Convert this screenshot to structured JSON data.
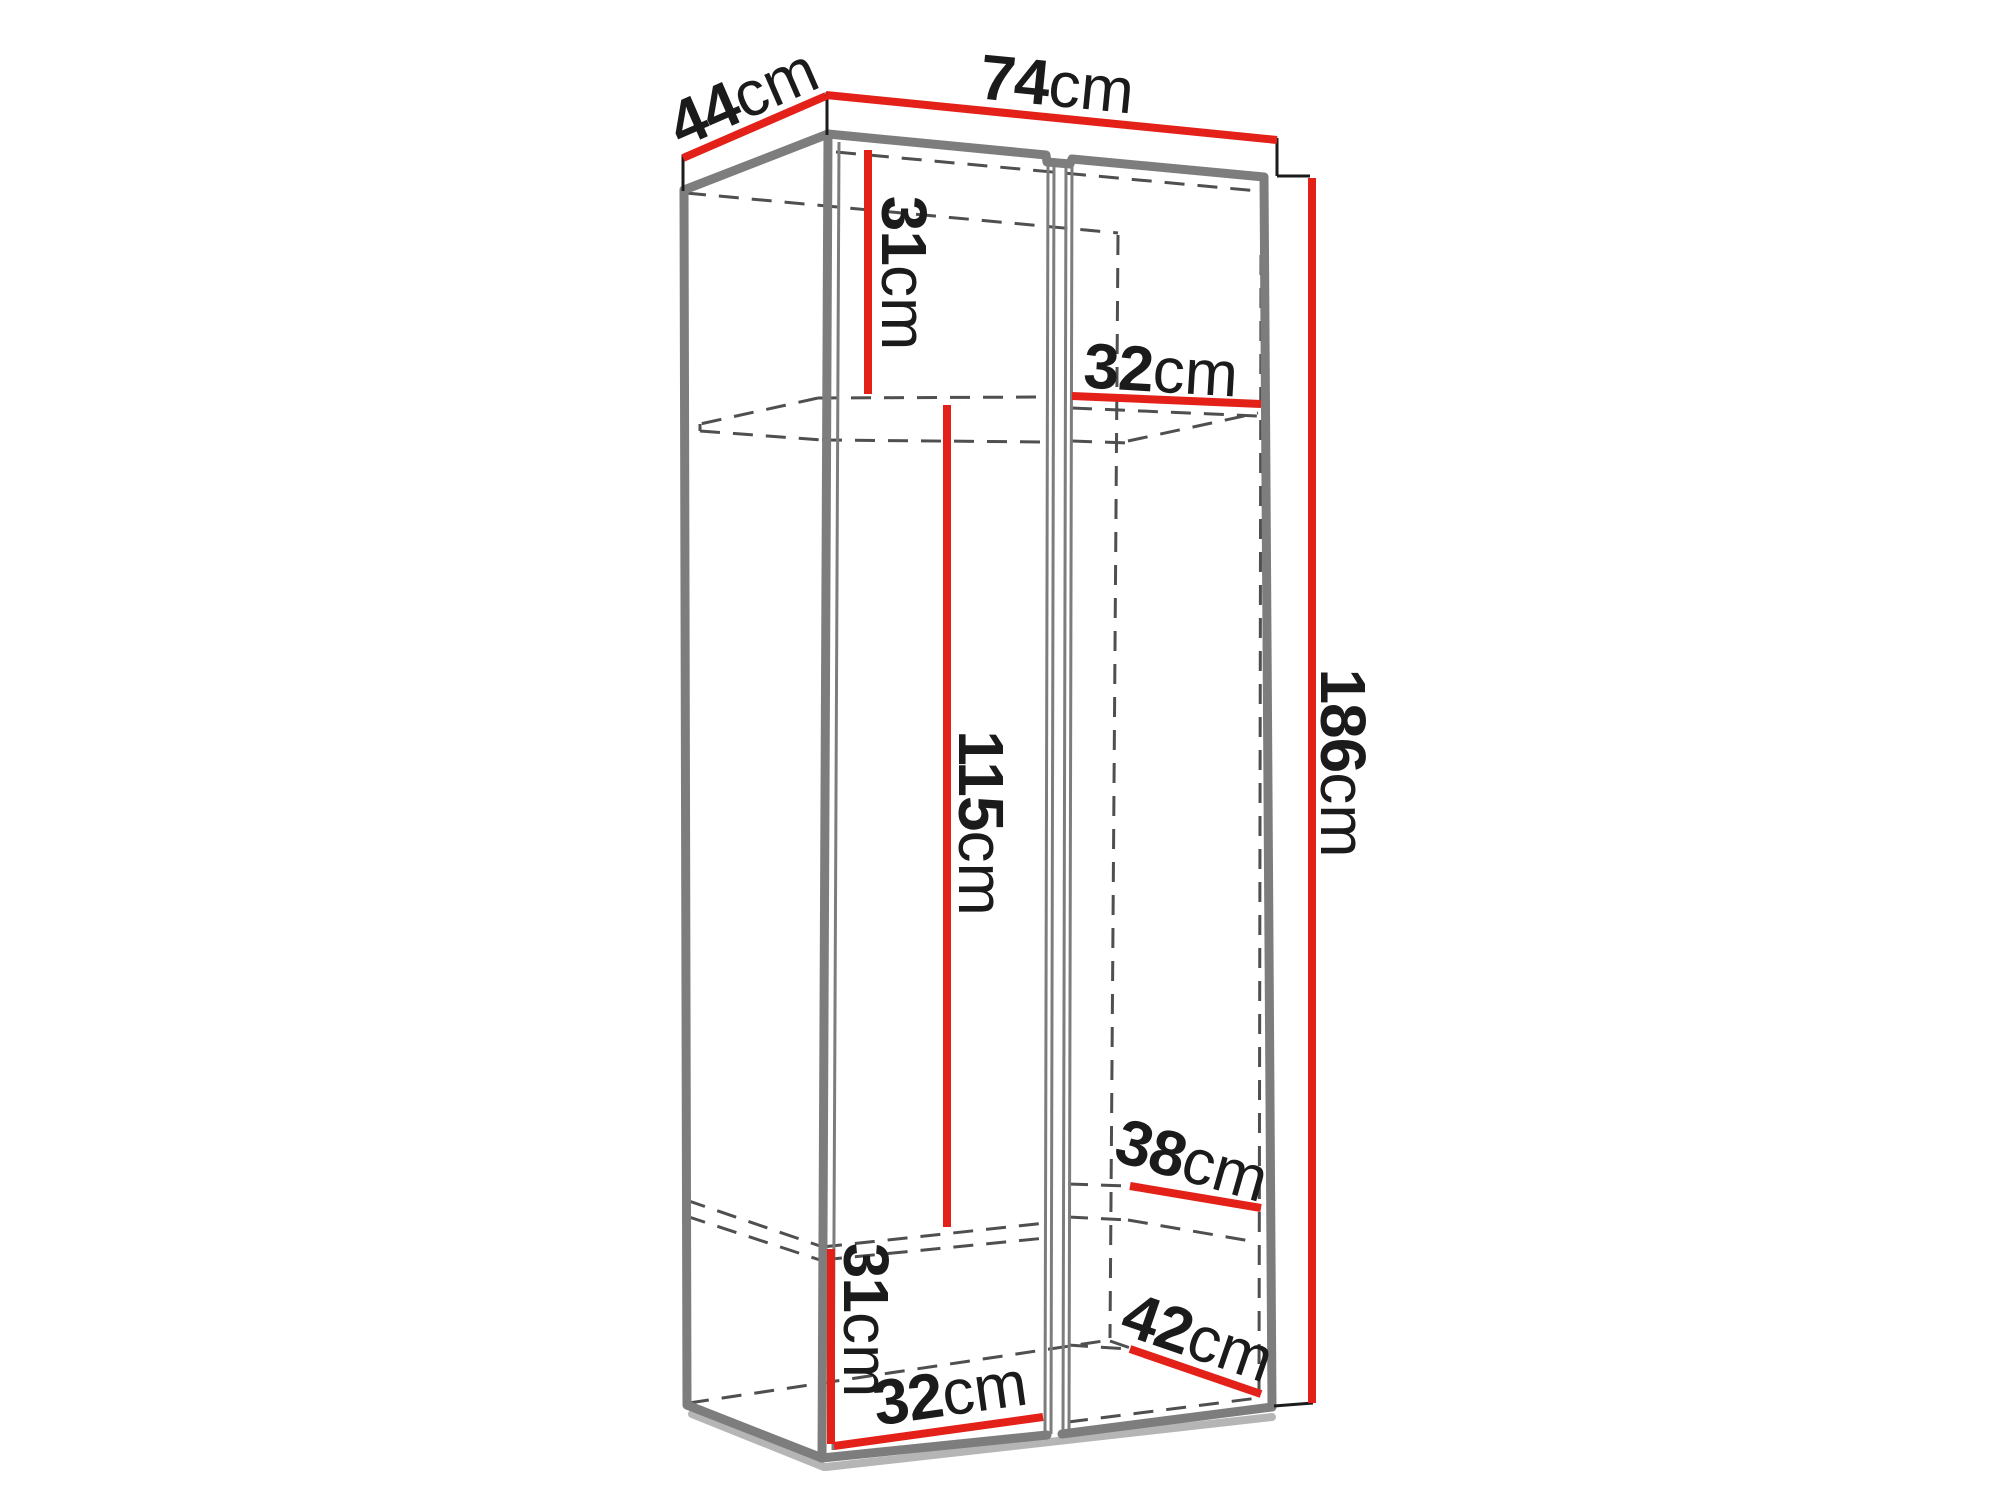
{
  "diagram": {
    "subject": "wardrobe-dimension-drawing",
    "unit": "cm",
    "colors": {
      "dimension": "#e32119",
      "edge": "#7d7d7d",
      "edge-light": "#b5b5b5",
      "hidden": "#4f4f4f",
      "text": "#1b1b1b",
      "background": "#ffffff"
    },
    "dimensions": {
      "top_depth": {
        "value": "44",
        "unit": "cm"
      },
      "top_width": {
        "value": "74",
        "unit": "cm"
      },
      "upper_section_height": {
        "value": "31",
        "unit": "cm"
      },
      "upper_right_inner_width": {
        "value": "32",
        "unit": "cm"
      },
      "middle_section_height": {
        "value": "115",
        "unit": "cm"
      },
      "overall_height": {
        "value": "186",
        "unit": "cm"
      },
      "shelf_depth": {
        "value": "38",
        "unit": "cm"
      },
      "bottom_inner_depth": {
        "value": "42",
        "unit": "cm"
      },
      "lower_section_height": {
        "value": "31",
        "unit": "cm"
      },
      "lower_inner_width": {
        "value": "32",
        "unit": "cm"
      }
    }
  }
}
